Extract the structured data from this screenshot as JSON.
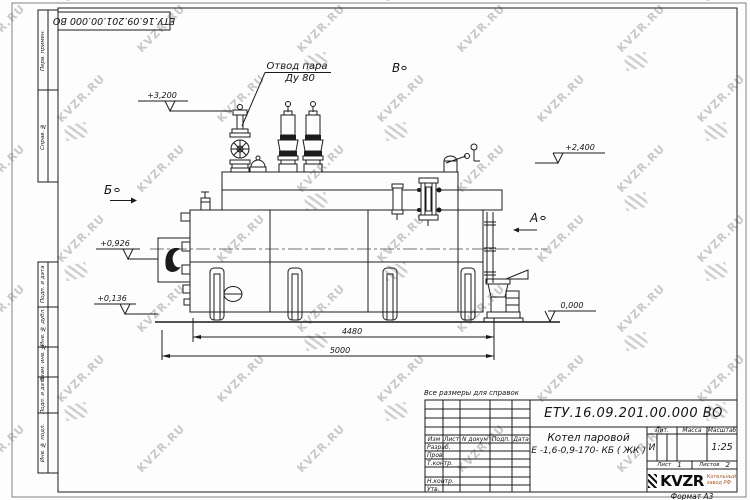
{
  "watermark": {
    "text": "KVZR.RU"
  },
  "corner_stamp": {
    "doc_number": "ЕТУ.16.09.201.00.000  ВО"
  },
  "margin": {
    "perv_primen": "Перв. примен.",
    "sprav_no": "Справ. №",
    "podp_data1": "Подп. и дата",
    "inv_dubl": "Инв. № дубл.",
    "vzam_inv": "Взам. инв. №",
    "podp_data2": "Подп. и дата",
    "inv_podl": "Инв. № подл."
  },
  "drawing": {
    "steam_label1": "Отвод пара",
    "steam_label2": "Ду 80",
    "view_b": "Б",
    "view_v": "В",
    "view_a": "А",
    "elev_3200": "+3,200",
    "elev_2400": "+2,400",
    "elev_0926": "+0,926",
    "elev_0136": "+0,136",
    "elev_0000": "0,000",
    "dim_inner": "4480",
    "dim_outer": "5000"
  },
  "note": "Все размеры для справок",
  "title_block": {
    "doc_number": "ЕТУ.16.09.201.00.000  ВО",
    "product_line1": "Котел паровой",
    "product_line2": "Е -1,6-0,9-170- КБ ( ЖК )",
    "col_izm": "Изм",
    "col_list": "Лист",
    "col_ndokum": "N докум",
    "col_podp": "Подп.",
    "col_data": "Дата",
    "row_razrab": "Разраб.",
    "row_prov": "Пров.",
    "row_tkontr": "Т.контр.",
    "row_nkontr": "Н.контр.",
    "row_utv": "Утв.",
    "lit_label": "Лит.",
    "massa_label": "Масса",
    "masshtab_label": "Масштаб",
    "lit_value": "И",
    "masshtab_value": "1:25",
    "list_label": "Лист",
    "list_value": "1",
    "listov_label": "Листов",
    "listov_value": "2",
    "brand": "KVZR",
    "brand_line1": "Котельный",
    "brand_line2": "завод РФ",
    "format_label": "Формат А3"
  }
}
